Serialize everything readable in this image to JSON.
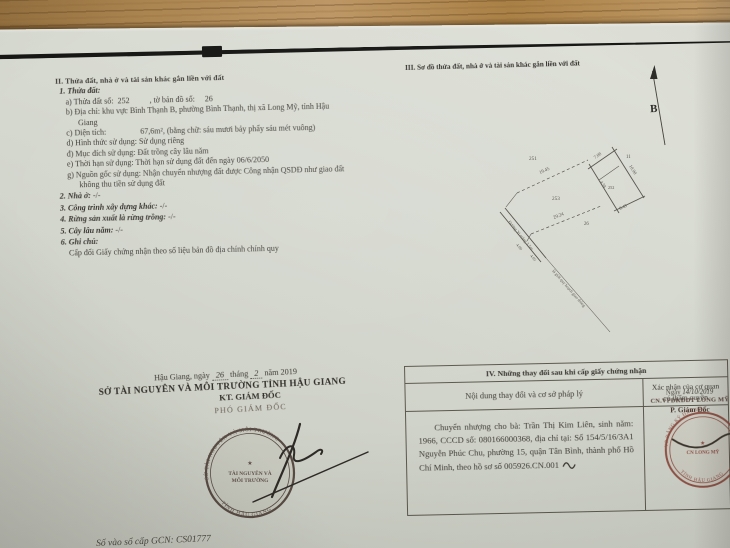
{
  "section2": {
    "heading": "II. Thửa đất, nhà ở và tài sản khác gắn liền với đất",
    "plot": {
      "label": "1. Thửa đất:",
      "a_label": "a) Thửa đất số:",
      "a_value": "252",
      "a_label2": ", tờ bản đồ số:",
      "a_value2": "26",
      "b_label": "b) Địa chỉ:",
      "b_value1": "khu vực Bình Thạnh B, phường Bình Thạnh, thị xã Long Mỹ, tỉnh Hậu",
      "b_value2": "Giang",
      "c_label": "c) Diện tích:",
      "c_value": "67,6m²,",
      "c_note": "(bằng chữ: sáu mươi bảy phẩy sáu mét vuông)",
      "d_label": "d) Hình thức sử dụng:",
      "d_value": "Sử dụng riêng",
      "dd_label": "đ) Mục đích sử dụng:",
      "dd_value": "Đất trồng cây lâu năm",
      "e_label": "e) Thời hạn sử dụng:",
      "e_value": "Thời hạn sử dụng đất đến ngày 06/6/2050",
      "g_label": "g) Nguồn gốc sử dụng:",
      "g_value1": "Nhận chuyển nhượng đất được Công nhận QSDĐ như giao đất",
      "g_value2": "không thu tiền sử dụng đất"
    },
    "house_label": "2. Nhà ở:",
    "house_value": "-/-",
    "construction_label": "3. Công trình xây dựng khác:",
    "construction_value": "-/-",
    "forest_label": "4. Rừng sản xuất là rừng trồng:",
    "forest_value": "-/-",
    "perennial_label": "5. Cây lâu năm:",
    "perennial_value": "-/-",
    "notes_label": "6. Ghi chú:",
    "notes_value": "Cấp đổi Giấy chứng nhận theo số liệu bản đồ địa chính chính quy"
  },
  "section3": {
    "heading": "III. Sơ đồ thửa đất, nhà ở và tài sản khác gắn liền với đất",
    "north_label": "B",
    "diagram": {
      "parcel_number": "252",
      "neighbor_251": "251",
      "neighbor_253": "253",
      "neighbor_26": "26",
      "neighbor_11": "11",
      "dim_top": "7.08",
      "dim_right": "10.90",
      "dim_left": "4.58",
      "dim_bottom": "8.43",
      "dim_upper_line": "19.45",
      "dim_lower_line": "29.24",
      "dim_road1": "4.00",
      "dim_road2": "4.05",
      "road_label": "Đường Xi măng 3.5m",
      "boundary_label": "lộ giới quy hoạch giao thông"
    }
  },
  "signature": {
    "place": "Hậu Giang, ngày",
    "day": "26",
    "thang": "tháng",
    "month": "2",
    "nam": "năm 2019",
    "agency": "SỞ TÀI NGUYÊN VÀ MÔI TRƯỜNG TỈNH HẬU GIANG",
    "title": "KT. GIÁM ĐỐC",
    "deputy": "PHÓ GIÁM ĐỐC",
    "stamp": {
      "ring_top": "SỞ TÀI NGUYÊN VÀ MÔI TRƯỜNG",
      "ring_bottom": "TỈNH HẬU GIANG",
      "star": "★",
      "center1": "TÀI NGUYÊN VÀ",
      "center2": "MÔI TRƯỜNG"
    }
  },
  "section4": {
    "heading": "IV. Những thay đổi sau khi cấp giấy chứng nhận",
    "col_left": "Nội dung thay đổi và cơ sở pháp lý",
    "col_right_1": "Xác nhận của cơ quan",
    "col_right_2": "có thẩm quyền",
    "entry": "Chuyển nhượng cho bà: Trần Thị Kim Liên, sinh năm: 1966, CCCD số: 080166000368, địa chỉ tại: Số 154/5/16/3A1 Nguyễn Phúc Chu, phường 15, quận Tân Bình, thành phố Hồ Chí Minh, theo hồ sơ số 005926.CN.001",
    "approval": {
      "date_label": "Ngày",
      "date_value": "14/10/2019",
      "office": "CN.VPĐKĐĐT LONG MỸ",
      "title": "P. Giám Đốc",
      "stamp_ring_top": "VP ĐĂNG KÝ ĐẤT ĐAI",
      "stamp_ring_bottom": "TỈNH HẬU GIANG",
      "stamp_center": "CN LONG MỸ",
      "stamp_star": "★"
    }
  },
  "footer": {
    "serial": "Số vào sổ cấp GCN: CS01777"
  }
}
